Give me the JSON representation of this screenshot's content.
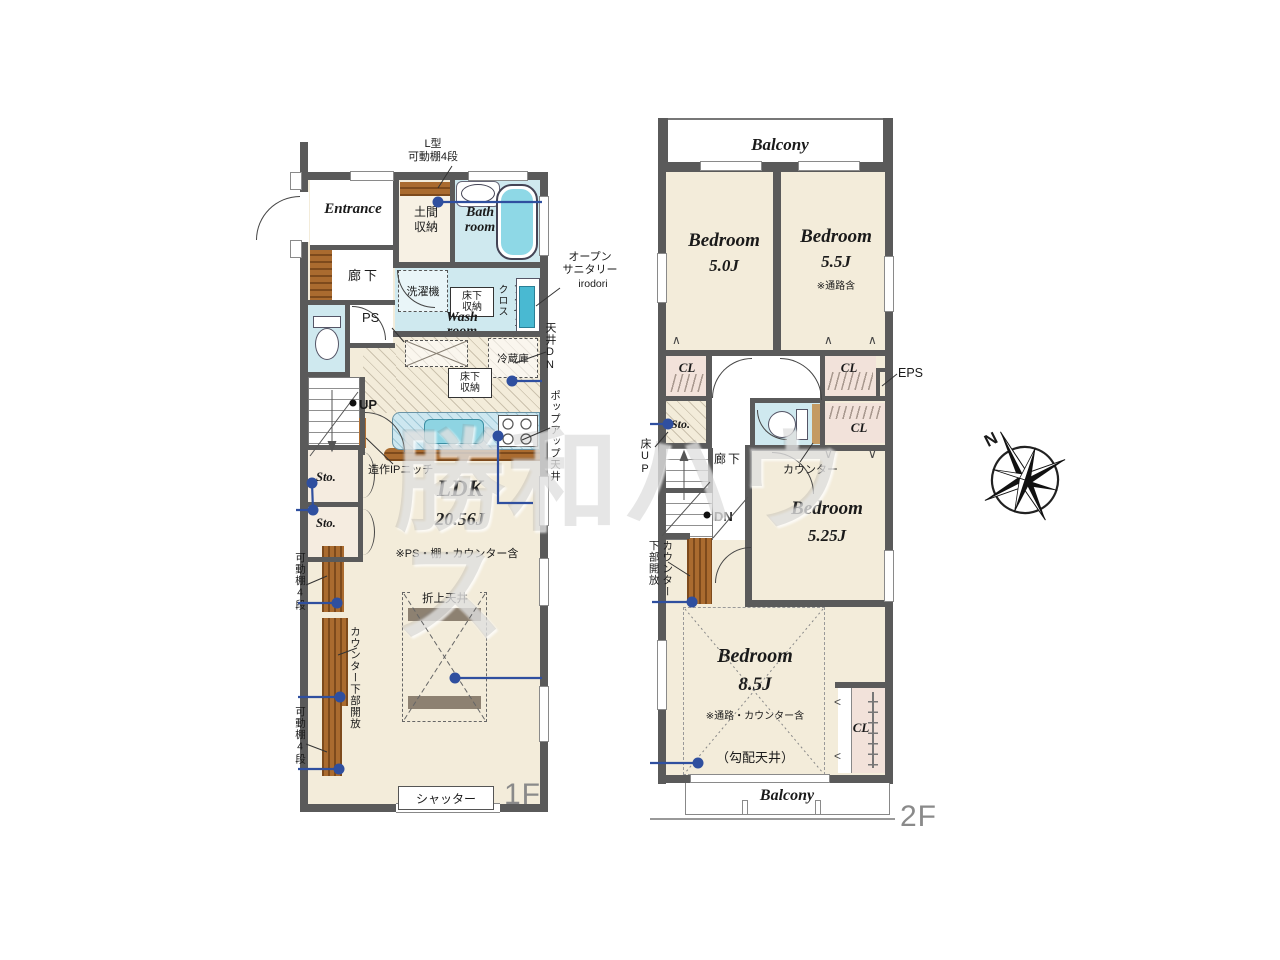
{
  "watermark": "勝和ハウス",
  "compass": {
    "north_label": "N"
  },
  "colors": {
    "wall": "#5a5a5a",
    "floor": "#f3ecda",
    "wet_area": "#cfe9ef",
    "tub": "#8ed8e6",
    "closet": "#f2e2da",
    "wood": "#aa6b2f",
    "annotation_blue": "#2f4f9f"
  },
  "floor1": {
    "floor_label": "1F",
    "entrance": "Entrance",
    "hallway": "廊下",
    "doma_storage": "土間\n収納",
    "l_shelf_note": "L型\n可動棚4段",
    "bath_room": "Bath\nroom",
    "washing_machine": "洗濯機",
    "underfloor_storage_wash": "床下\n収納",
    "wash_room": "Wash\nroom",
    "accent_cloth": "アクセント\nクロス",
    "open_sanitary": "オープン\nサニタリー",
    "open_sanitary_sub": "irodori",
    "ps": "PS",
    "ceiling_down": "天井DN",
    "refrigerator": "冷蔵庫",
    "underfloor_storage_kitchen": "床下\n収納",
    "popup_ceiling": "ポップアップ天井",
    "up": "UP",
    "ip_niche": "造作IPニッチ",
    "storage1": "Sto.",
    "storage2": "Sto.",
    "movable_shelf_upper": "可動棚4段",
    "counter_open_below": "カウンター下部開放",
    "movable_shelf_lower": "可動棚4段",
    "ldk": "LDK",
    "ldk_size": "20.56J",
    "ldk_note": "※PS・棚・カウンター含",
    "coffered_ceiling": "折上天井",
    "shutter": "シャッター"
  },
  "floor2": {
    "floor_label": "2F",
    "balcony_top": "Balcony",
    "balcony_bottom": "Balcony",
    "bedroom_50": "Bedroom",
    "bedroom_50_size": "5.0J",
    "bedroom_55": "Bedroom",
    "bedroom_55_size": "5.5J",
    "bedroom_55_note": "※通路含",
    "cl_1": "CL",
    "cl_2": "CL",
    "cl_3": "CL",
    "cl_4": "CL",
    "eps": "EPS",
    "storage": "Sto.",
    "floor_up": "床UP",
    "hallway": "廊下",
    "counter": "カウンター",
    "dn": "DN",
    "bedroom_525": "Bedroom",
    "bedroom_525_size": "5.25J",
    "counter_open_below": "カウンター\n下部開放",
    "bedroom_85": "Bedroom",
    "bedroom_85_size": "8.5J",
    "bedroom_85_note": "※通路・カウンター含",
    "sloped_ceiling": "（勾配天井）"
  }
}
